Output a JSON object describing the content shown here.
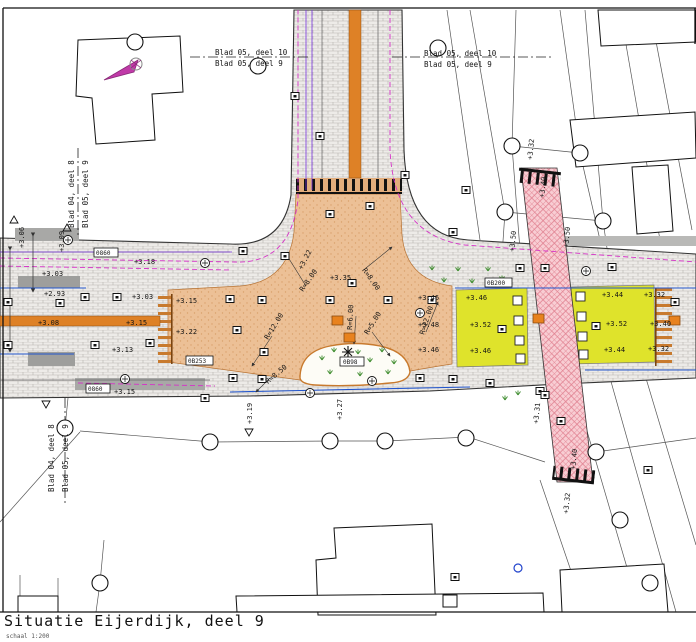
{
  "title_block": {
    "title": "Situatie Eijerdijk, deel 9",
    "scale": "schaal 1:200"
  },
  "sheet_refs": {
    "top_center_above": "Blad 05, deel 10",
    "top_center_below": "Blad 05, deel 9",
    "top_right_above": "Blad 05, deel 10",
    "top_right_below": "Blad 05, deel 9",
    "left_west": "Blad 04, deel 8",
    "left_east": "Blad 05, deel 9",
    "bottom_left_west": "Blad 04, deel 8",
    "bottom_left_east": "Blad 05, deel 9"
  },
  "elevations": [
    "+3.06",
    "+3.09",
    "+3.03",
    "+2.93",
    "+3.08",
    "+3.15",
    "+3.03",
    "+3.13",
    "+3.15",
    "+3.18",
    "+3.15",
    "+3.22",
    "+3.22",
    "+3.35",
    "+3.19",
    "+3.27",
    "+3.46",
    "+3.48",
    "+3.46",
    "+3.46",
    "+3.52",
    "+3.46",
    "+3.44",
    "+3.52",
    "+3.44",
    "+3.32",
    "+3.40",
    "+3.32",
    "+3.32",
    "+3.40",
    "+3.50",
    "+3.50",
    "+3.31",
    "+3.40",
    "+3.32"
  ],
  "radii": [
    "R=8.00",
    "R=8.00",
    "R=6.00",
    "R=5.00",
    "R=12.00",
    "R=12.00",
    "R=8.50"
  ],
  "codes": [
    "0860",
    "0860",
    "0B200",
    "0B253",
    "0B98"
  ],
  "colors": {
    "plateau_tan": "#ecc096",
    "plateau_yellow": "#dfe32b",
    "crossing_pink": "#f8cdd3",
    "crossing_hatch": "#e08090",
    "gutter_orange": "#de8126",
    "cable_magenta": "#d633c8",
    "water_blue": "#2255cc",
    "vegetation_green": "#3a8a2a",
    "north_arrow_magenta": "#c03aa8"
  }
}
